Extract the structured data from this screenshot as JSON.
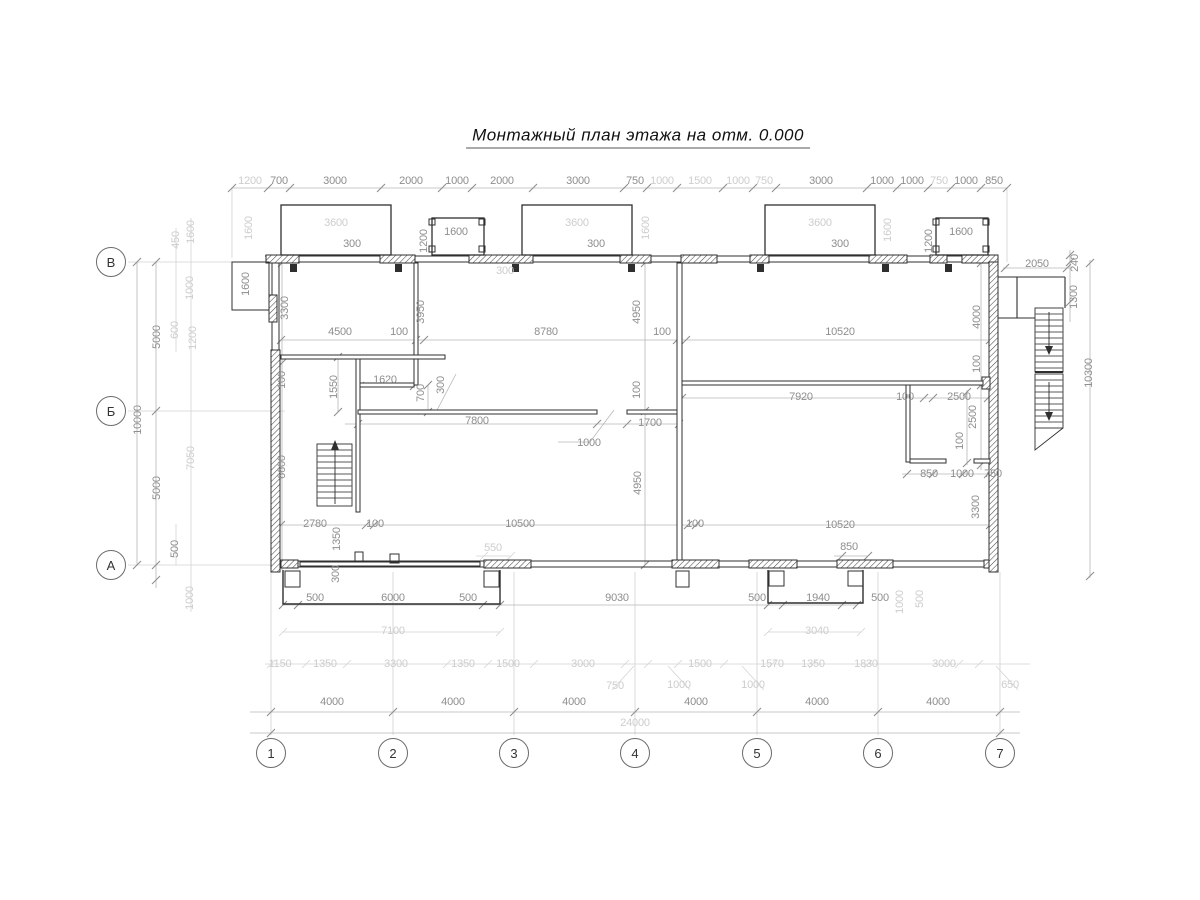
{
  "title": "Монтажный план этажа на отм. 0.000",
  "colors": {
    "wall": "#2f2f2f",
    "dim_text": "#8e8e8e",
    "dim_text_light": "#cdcdcd",
    "dim_line": "#b8b8b8",
    "axis_line": "#d2d2d2"
  },
  "axes": {
    "bottom_y": 753,
    "bottom": [
      {
        "label": "1",
        "x": 271
      },
      {
        "label": "2",
        "x": 393
      },
      {
        "label": "3",
        "x": 514
      },
      {
        "label": "4",
        "x": 635
      },
      {
        "label": "5",
        "x": 757
      },
      {
        "label": "6",
        "x": 878
      },
      {
        "label": "7",
        "x": 1000
      }
    ],
    "left_x": 111,
    "left": [
      {
        "label": "В",
        "y": 262
      },
      {
        "label": "Б",
        "y": 411
      },
      {
        "label": "А",
        "y": 565
      }
    ]
  },
  "dims": [
    {
      "t": "1200",
      "x": 250,
      "y": 181,
      "light": true
    },
    {
      "t": "700",
      "x": 279,
      "y": 181
    },
    {
      "t": "3000",
      "x": 335,
      "y": 181
    },
    {
      "t": "2000",
      "x": 411,
      "y": 181
    },
    {
      "t": "1000",
      "x": 457,
      "y": 181
    },
    {
      "t": "2000",
      "x": 502,
      "y": 181
    },
    {
      "t": "3000",
      "x": 578,
      "y": 181
    },
    {
      "t": "750",
      "x": 635,
      "y": 181
    },
    {
      "t": "1000",
      "x": 662,
      "y": 181,
      "light": true
    },
    {
      "t": "1500",
      "x": 700,
      "y": 181,
      "light": true
    },
    {
      "t": "1000",
      "x": 738,
      "y": 181,
      "light": true
    },
    {
      "t": "750",
      "x": 764,
      "y": 181,
      "light": true
    },
    {
      "t": "3000",
      "x": 821,
      "y": 181
    },
    {
      "t": "1000",
      "x": 882,
      "y": 181
    },
    {
      "t": "1000",
      "x": 912,
      "y": 181
    },
    {
      "t": "750",
      "x": 939,
      "y": 181,
      "light": true
    },
    {
      "t": "1000",
      "x": 966,
      "y": 181
    },
    {
      "t": "850",
      "x": 994,
      "y": 181
    },
    {
      "t": "3600",
      "x": 336,
      "y": 223,
      "light": true
    },
    {
      "t": "3600",
      "x": 577,
      "y": 223,
      "light": true
    },
    {
      "t": "3600",
      "x": 820,
      "y": 223,
      "light": true
    },
    {
      "t": "300",
      "x": 352,
      "y": 244
    },
    {
      "t": "300",
      "x": 596,
      "y": 244
    },
    {
      "t": "300",
      "x": 840,
      "y": 244
    },
    {
      "t": "1600",
      "x": 456,
      "y": 232
    },
    {
      "t": "1200",
      "x": 424,
      "y": 241,
      "rot": true
    },
    {
      "t": "1600",
      "x": 961,
      "y": 232
    },
    {
      "t": "1200",
      "x": 929,
      "y": 241,
      "rot": true
    },
    {
      "t": "1600",
      "x": 646,
      "y": 228,
      "rot": true,
      "light": true
    },
    {
      "t": "1600",
      "x": 888,
      "y": 230,
      "rot": true,
      "light": true
    },
    {
      "t": "1600",
      "x": 249,
      "y": 228,
      "rot": true,
      "light": true
    },
    {
      "t": "300",
      "x": 505,
      "y": 271,
      "light": true
    },
    {
      "t": "450",
      "x": 176,
      "y": 240,
      "rot": true,
      "light": true
    },
    {
      "t": "1600",
      "x": 191,
      "y": 232,
      "rot": true,
      "light": true
    },
    {
      "t": "1000",
      "x": 190,
      "y": 288,
      "rot": true,
      "light": true
    },
    {
      "t": "600",
      "x": 175,
      "y": 330,
      "rot": true,
      "light": true
    },
    {
      "t": "1200",
      "x": 193,
      "y": 338,
      "rot": true,
      "light": true
    },
    {
      "t": "1600",
      "x": 246,
      "y": 284,
      "rot": true
    },
    {
      "t": "5000",
      "x": 157,
      "y": 337,
      "rot": true
    },
    {
      "t": "10000",
      "x": 138,
      "y": 420,
      "rot": true
    },
    {
      "t": "5000",
      "x": 157,
      "y": 488,
      "rot": true
    },
    {
      "t": "500",
      "x": 175,
      "y": 549,
      "rot": true
    },
    {
      "t": "7050",
      "x": 191,
      "y": 458,
      "rot": true,
      "light": true
    },
    {
      "t": "1000",
      "x": 190,
      "y": 598,
      "rot": true,
      "light": true
    },
    {
      "t": "3300",
      "x": 285,
      "y": 308,
      "rot": true
    },
    {
      "t": "100",
      "x": 282,
      "y": 380,
      "rot": true
    },
    {
      "t": "6600",
      "x": 282,
      "y": 467,
      "rot": true
    },
    {
      "t": "4500",
      "x": 340,
      "y": 332
    },
    {
      "t": "100",
      "x": 399,
      "y": 332
    },
    {
      "t": "8780",
      "x": 546,
      "y": 332
    },
    {
      "t": "100",
      "x": 662,
      "y": 332
    },
    {
      "t": "10520",
      "x": 840,
      "y": 332
    },
    {
      "t": "3950",
      "x": 421,
      "y": 312,
      "rot": true
    },
    {
      "t": "4950",
      "x": 637,
      "y": 312,
      "rot": true
    },
    {
      "t": "4000",
      "x": 977,
      "y": 317,
      "rot": true
    },
    {
      "t": "1550",
      "x": 334,
      "y": 387,
      "rot": true
    },
    {
      "t": "1620",
      "x": 385,
      "y": 380
    },
    {
      "t": "700",
      "x": 421,
      "y": 393,
      "rot": true
    },
    {
      "t": "300",
      "x": 441,
      "y": 385,
      "rot": true
    },
    {
      "t": "7800",
      "x": 477,
      "y": 421
    },
    {
      "t": "1700",
      "x": 650,
      "y": 423
    },
    {
      "t": "100",
      "x": 637,
      "y": 390,
      "rot": true
    },
    {
      "t": "1000",
      "x": 589,
      "y": 443
    },
    {
      "t": "7920",
      "x": 801,
      "y": 397
    },
    {
      "t": "100",
      "x": 905,
      "y": 397
    },
    {
      "t": "2500",
      "x": 959,
      "y": 397
    },
    {
      "t": "100",
      "x": 977,
      "y": 364,
      "rot": true
    },
    {
      "t": "2500",
      "x": 973,
      "y": 417,
      "rot": true
    },
    {
      "t": "100",
      "x": 960,
      "y": 441,
      "rot": true
    },
    {
      "t": "850",
      "x": 929,
      "y": 474
    },
    {
      "t": "1000",
      "x": 962,
      "y": 474
    },
    {
      "t": "750",
      "x": 993,
      "y": 474
    },
    {
      "t": "4950",
      "x": 638,
      "y": 483,
      "rot": true
    },
    {
      "t": "3300",
      "x": 976,
      "y": 507,
      "rot": true
    },
    {
      "t": "2780",
      "x": 315,
      "y": 524
    },
    {
      "t": "100",
      "x": 375,
      "y": 524
    },
    {
      "t": "10500",
      "x": 520,
      "y": 524
    },
    {
      "t": "100",
      "x": 695,
      "y": 524
    },
    {
      "t": "10520",
      "x": 840,
      "y": 525
    },
    {
      "t": "1350",
      "x": 337,
      "y": 539,
      "rot": true
    },
    {
      "t": "300",
      "x": 336,
      "y": 574,
      "rot": true
    },
    {
      "t": "550",
      "x": 493,
      "y": 548,
      "light": true
    },
    {
      "t": "850",
      "x": 849,
      "y": 547
    },
    {
      "t": "500",
      "x": 315,
      "y": 598
    },
    {
      "t": "6000",
      "x": 393,
      "y": 598
    },
    {
      "t": "500",
      "x": 468,
      "y": 598
    },
    {
      "t": "9030",
      "x": 617,
      "y": 598
    },
    {
      "t": "500",
      "x": 757,
      "y": 598
    },
    {
      "t": "1940",
      "x": 818,
      "y": 598
    },
    {
      "t": "500",
      "x": 880,
      "y": 598
    },
    {
      "t": "7100",
      "x": 393,
      "y": 631,
      "light": true
    },
    {
      "t": "3040",
      "x": 817,
      "y": 631,
      "light": true
    },
    {
      "t": "1000",
      "x": 900,
      "y": 602,
      "rot": true,
      "light": true
    },
    {
      "t": "500",
      "x": 920,
      "y": 599,
      "rot": true,
      "light": true
    },
    {
      "t": "1150",
      "x": 280,
      "y": 664,
      "light": true
    },
    {
      "t": "1350",
      "x": 325,
      "y": 664,
      "light": true
    },
    {
      "t": "3300",
      "x": 396,
      "y": 664,
      "light": true
    },
    {
      "t": "1350",
      "x": 463,
      "y": 664,
      "light": true
    },
    {
      "t": "1500",
      "x": 508,
      "y": 664,
      "light": true
    },
    {
      "t": "3000",
      "x": 583,
      "y": 664,
      "light": true
    },
    {
      "t": "1500",
      "x": 700,
      "y": 664,
      "light": true
    },
    {
      "t": "1570",
      "x": 772,
      "y": 664,
      "light": true
    },
    {
      "t": "1350",
      "x": 813,
      "y": 664,
      "light": true
    },
    {
      "t": "1830",
      "x": 866,
      "y": 664,
      "light": true
    },
    {
      "t": "3000",
      "x": 944,
      "y": 664,
      "light": true
    },
    {
      "t": "750",
      "x": 615,
      "y": 686,
      "light": true
    },
    {
      "t": "1000",
      "x": 679,
      "y": 685,
      "light": true
    },
    {
      "t": "1000",
      "x": 753,
      "y": 685,
      "light": true
    },
    {
      "t": "650",
      "x": 1010,
      "y": 685,
      "light": true
    },
    {
      "t": "4000",
      "x": 332,
      "y": 702
    },
    {
      "t": "4000",
      "x": 453,
      "y": 702
    },
    {
      "t": "4000",
      "x": 574,
      "y": 702
    },
    {
      "t": "4000",
      "x": 696,
      "y": 702
    },
    {
      "t": "4000",
      "x": 817,
      "y": 702
    },
    {
      "t": "4000",
      "x": 938,
      "y": 702
    },
    {
      "t": "24000",
      "x": 635,
      "y": 723,
      "light": true
    },
    {
      "t": "2050",
      "x": 1037,
      "y": 264
    },
    {
      "t": "240",
      "x": 1075,
      "y": 263,
      "rot": true
    },
    {
      "t": "1300",
      "x": 1074,
      "y": 297,
      "rot": true
    },
    {
      "t": "10300",
      "x": 1089,
      "y": 373,
      "rot": true
    }
  ]
}
